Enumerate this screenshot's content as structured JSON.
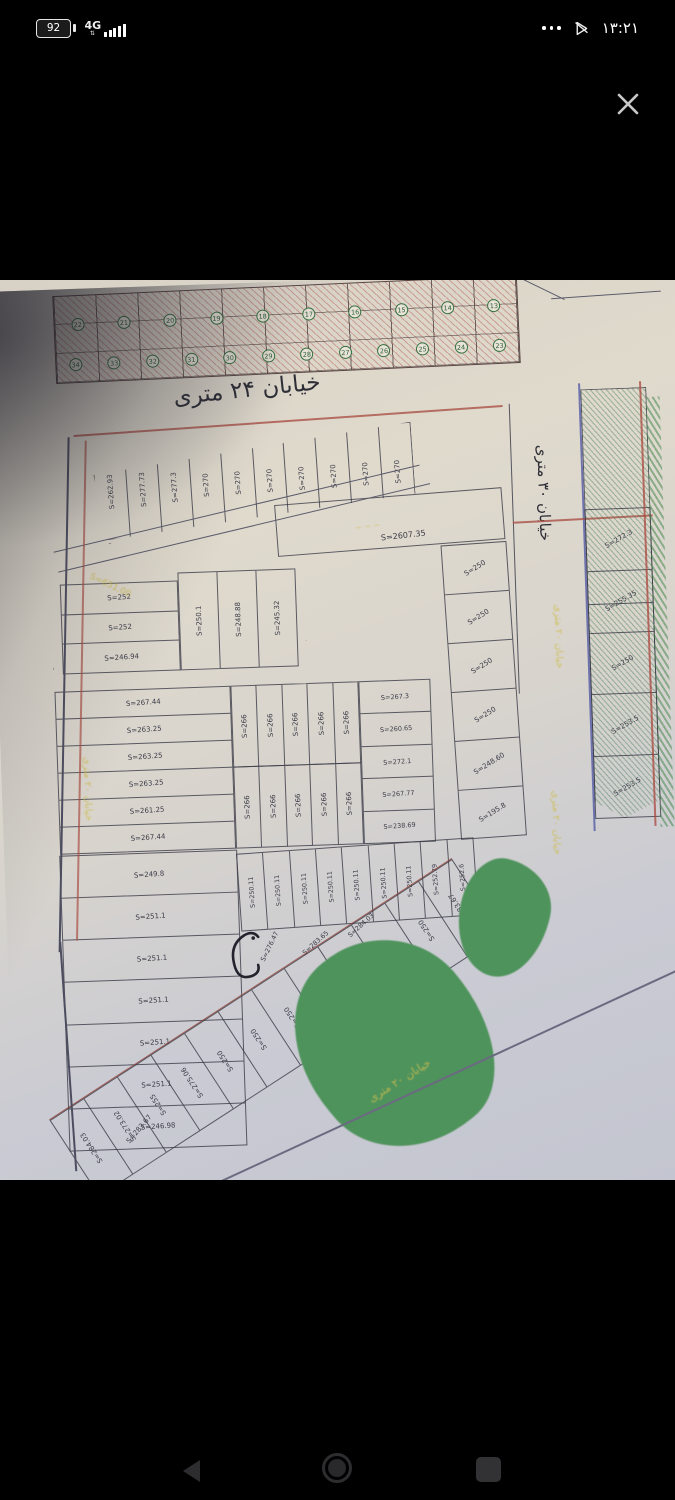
{
  "status_bar": {
    "battery_percent": "92",
    "network_type": "4G",
    "time": "۱۳:۲۱",
    "icons": [
      "battery-icon",
      "signal-bars-icon",
      "more-dots-icon",
      "play-slash-icon"
    ]
  },
  "viewer": {
    "close_icon": "close-icon"
  },
  "map": {
    "streets": {
      "s24": "خیابان ۲۴ متری",
      "s30": "خیابان ۳۰ متری",
      "s20": "خیابان ۲۰ متری"
    },
    "areas": {
      "big_plot": "S=2607.35",
      "triangle_street": "S=651.00"
    },
    "top_strip": {
      "row1_numbers": [
        "22",
        "21",
        "20",
        "19",
        "18",
        "17",
        "16",
        "15",
        "14",
        "13"
      ],
      "row2_numbers": [
        "34",
        "33",
        "32",
        "31",
        "30",
        "29",
        "28",
        "27",
        "26",
        "25",
        "24",
        "23"
      ]
    },
    "blocks": {
      "row_a": [
        "S=262.93",
        "S=277.73",
        "S=277.3",
        "S=270",
        "S=270",
        "S=270",
        "S=270",
        "S=270",
        "S=270",
        "S=270"
      ],
      "right_col": [
        "S=272.3",
        "S=255.35",
        "S=250",
        "S=253.5",
        "S=253.5"
      ],
      "mid_right_col": [
        "S=250",
        "S=250",
        "S=250",
        "S=250",
        "S=248.60",
        "S=195.8"
      ],
      "triangle_left": [
        "S=252",
        "S=252",
        "S=246.94"
      ],
      "triangle_cols": [
        "S=250.1",
        "S=248.88",
        "S=245.32"
      ],
      "middle_left": [
        "S=267.44",
        "S=263.25",
        "S=263.25",
        "S=263.25",
        "S=261.25",
        "S=267.44"
      ],
      "middle_center_top": [
        "S=266",
        "S=266",
        "S=266",
        "S=266",
        "S=266"
      ],
      "middle_center_bottom": [
        "S=266",
        "S=266",
        "S=266",
        "S=266",
        "S=266"
      ],
      "middle_right": [
        "S=267.3",
        "S=260.65",
        "S=272.1",
        "S=267.77",
        "S=238.69"
      ],
      "lower_left": [
        "S=249.8",
        "S=251.1",
        "S=251.1",
        "S=251.1",
        "S=251.1",
        "S=251.1",
        "S=246.98"
      ],
      "lower_top": [
        "S=250.11",
        "S=250.11",
        "S=250.11",
        "S=250.11",
        "S=250.11",
        "S=250.11",
        "S=250.11",
        "S=252.79",
        "S=252.6"
      ],
      "mid_labels": [
        "S=276.47",
        "S=283.65",
        "S=284.03"
      ],
      "diagonal": [
        "S=284.03",
        "S=273.02",
        "S=255",
        "S=275.06",
        "S=250",
        "S=250",
        "S=250",
        "S=250",
        "S=250",
        "S=250",
        "S=250",
        "S=283.67"
      ],
      "corner_label": "S=283.67"
    }
  },
  "colors": {
    "paper": "#ded8cc",
    "paper_cool": "#c6c8d2",
    "plot_line": "#4c4c58",
    "boundary_red": "#b05a4e",
    "boundary_blue": "#5b62a8",
    "park_green": "#4f935c",
    "hatch_red": "#b04842",
    "hatch_green": "#3f7a4a",
    "street_label_yellow": "#d3c34f",
    "ink": "#2f2f35"
  },
  "nav_bar": {
    "icons": [
      "back-icon",
      "home-icon",
      "recents-icon"
    ]
  }
}
